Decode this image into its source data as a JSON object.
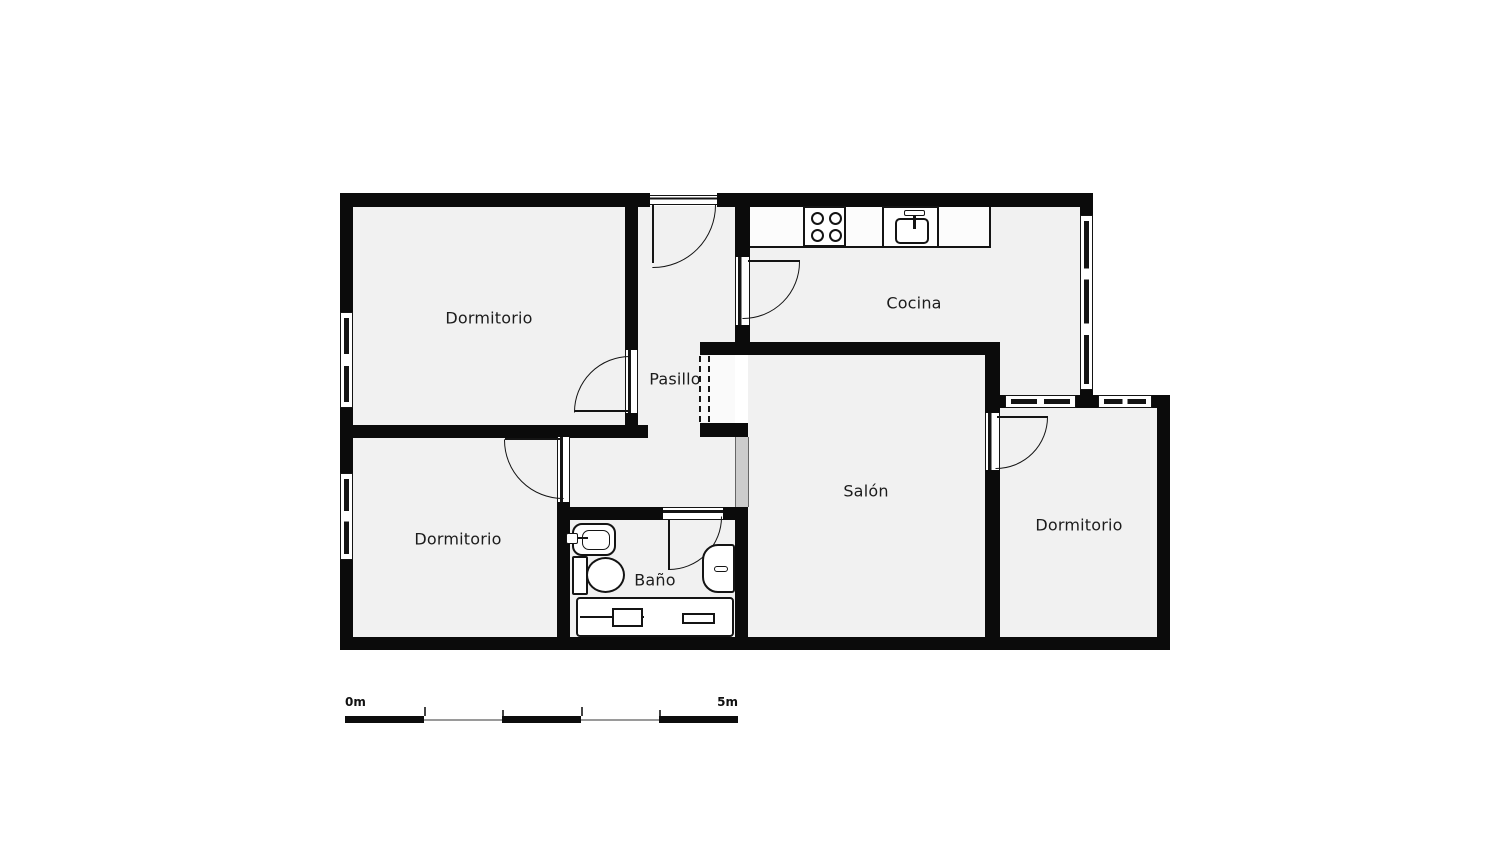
{
  "plan": {
    "rooms": {
      "dormitorio_tl": {
        "label": "Dormitorio"
      },
      "pasillo": {
        "label": "Pasillo"
      },
      "cocina": {
        "label": "Cocina"
      },
      "salon": {
        "label": "Salón"
      },
      "dormitorio_bl": {
        "label": "Dormitorio"
      },
      "bano": {
        "label": "Baño"
      },
      "dormitorio_r": {
        "label": "Dormitorio"
      }
    },
    "scale_bar": {
      "start_label": "0m",
      "end_label": "5m"
    },
    "colors": {
      "wall": "#0b0b0b",
      "floor": "#f1f1f1",
      "line": "#141414",
      "glazing": "#cccccc",
      "background": "#ffffff"
    },
    "icons": {
      "stove": "stove-icon",
      "kitchen_sink": "kitchen-sink-icon",
      "washbasin": "washbasin-icon",
      "toilet": "toilet-icon",
      "bidet": "bidet-icon",
      "bathtub": "bathtub-icon"
    }
  }
}
